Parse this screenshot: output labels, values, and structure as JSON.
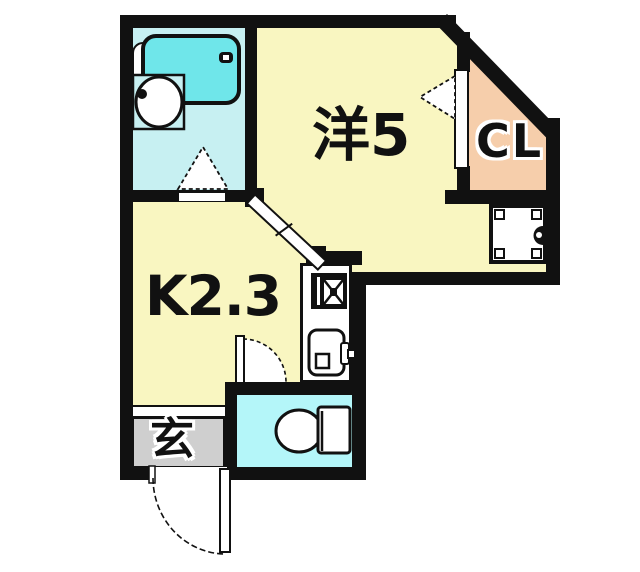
{
  "image": {
    "width": 640,
    "height": 572,
    "kind": "apartment floor plan"
  },
  "rooms": {
    "western": {
      "label": "洋5"
    },
    "kitchen": {
      "label": "K2.3"
    },
    "closet": {
      "label": "CL"
    },
    "entrance": {
      "label": "玄"
    }
  },
  "fixtures": [
    "bathtub-icon",
    "washbasin-icon",
    "toilet-icon",
    "stove-icon",
    "kitchen-sink-icon",
    "washing-machine-pan-icon",
    "bathroom-door-swing",
    "closet-door-swing",
    "kitchen-door-swing",
    "entrance-door-swing",
    "kitchen-sliding-door"
  ],
  "colors": {
    "wall": "#111111",
    "room_yellow": "#F9F6C1",
    "bathroom_floor": "#C7F0F2",
    "bathtub_fill": "#6FE6EA",
    "toilet_floor": "#B4F6F9",
    "closet_peach": "#F6CEAB",
    "entrance_gray": "#CFCFCF",
    "door_white": "#FFFFFF"
  }
}
